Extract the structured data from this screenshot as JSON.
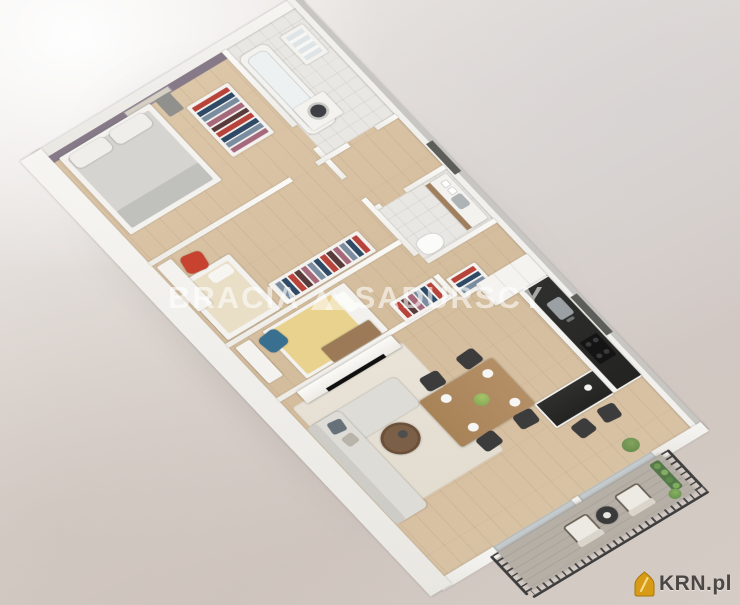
{
  "scene": {
    "type": "3d-apartment-floorplan-render",
    "background_top": "#f1eeec",
    "background_bottom": "#d0c6c0"
  },
  "watermark": {
    "brand_part1": "BRACIA",
    "brand_part2": "SADURSCY",
    "logo_icon": "double-triangle-icon",
    "color": "#ffffff"
  },
  "corner_logo": {
    "text": "KRN.pl",
    "icon": "gold-house-icon",
    "icon_color": "#d79b15",
    "text_color": "#4a4745"
  },
  "palette": {
    "accent_bedroom_wall": "#867a88",
    "wood_floor": "#d6c0a2",
    "tile_floor": "#e8e7e3",
    "kitchen_countertop": "#2b2b2b",
    "red_desk_chair": "#c7432f",
    "blue_desk_chair": "#39708f",
    "yellow_bed_cover": "#e8d28e",
    "sofa": "#dedcd7",
    "dining_table": "#b08b62",
    "balcony_railing": "#3d3d3d",
    "balcony_floor": "#b5afa6"
  },
  "floorplan": {
    "rooms": [
      {
        "name": "master-bedroom",
        "features": [
          "purple accent wall",
          "wall art",
          "double bed",
          "nightstand",
          "open wardrobe with clothes"
        ]
      },
      {
        "name": "bathroom-1",
        "features": [
          "bathtub",
          "washer-dryer",
          "shelf"
        ]
      },
      {
        "name": "bedroom-2",
        "features": [
          "single bed",
          "desk",
          "red chair",
          "open wardrobe"
        ]
      },
      {
        "name": "bedroom-3",
        "features": [
          "single bed yellow cover",
          "desk",
          "blue chair",
          "wardrobe",
          "wood cabinet"
        ]
      },
      {
        "name": "bathroom-2",
        "features": [
          "vanity with sink",
          "towels",
          "toilet"
        ]
      },
      {
        "name": "hallway",
        "features": [
          "storage shelf"
        ]
      },
      {
        "name": "kitchen",
        "features": [
          "tall cabinets",
          "black countertop",
          "sink",
          "cooktop",
          "peninsula with bar stools"
        ]
      },
      {
        "name": "living-dining",
        "features": [
          "dining table with 4 chairs",
          "plates",
          "flowers",
          "corner sofa",
          "round coffee table",
          "rug",
          "TV media wall"
        ]
      },
      {
        "name": "balcony",
        "features": [
          "metal railing",
          "two armchairs",
          "round table",
          "planter with flowers"
        ]
      }
    ]
  }
}
